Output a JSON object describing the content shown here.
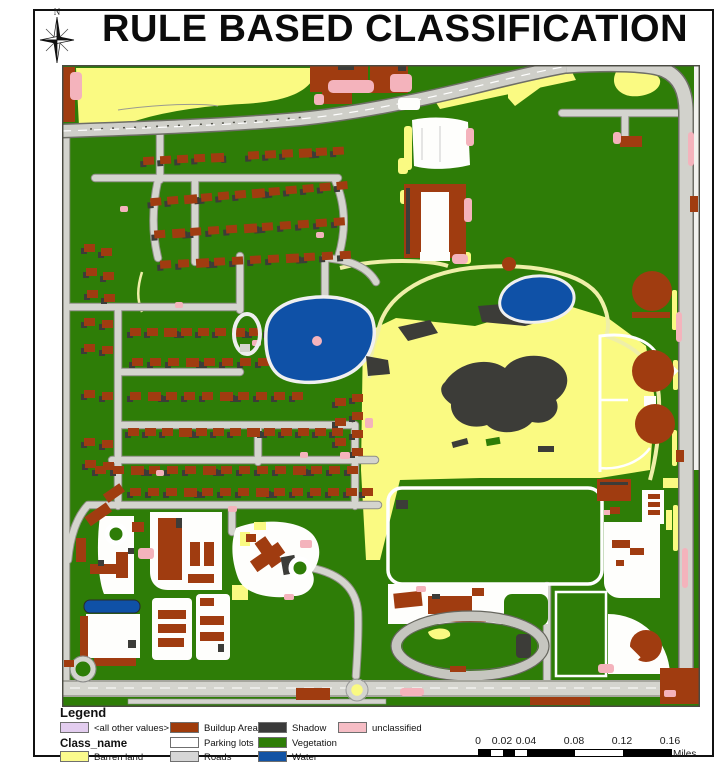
{
  "title": "RULE BASED CLASSIFICATION",
  "north_arrow": {
    "label": "N"
  },
  "legend": {
    "title": "Legend",
    "class_field_label": "Class_name",
    "items": [
      {
        "label": "<all other values>",
        "color": "#E3CDEF"
      },
      {
        "label": "Barren land",
        "color": "#FBFB8D"
      },
      {
        "label": "Buildup Area",
        "color": "#9E3B0B"
      },
      {
        "label": "Parking lots",
        "color": "#FFFFFF"
      },
      {
        "label": "Roads",
        "color": "#D6D6D6"
      },
      {
        "label": "Shadow",
        "color": "#3A3A3A"
      },
      {
        "label": "Vegetation",
        "color": "#2E7D07"
      },
      {
        "label": "Water",
        "color": "#1253A4"
      },
      {
        "label": "unclassified",
        "color": "#F6BDC5"
      }
    ]
  },
  "scale_bar": {
    "ticks": [
      "0",
      "0.02",
      "0.04",
      "0.08",
      "0.12",
      "0.16"
    ],
    "unit": "Miles"
  },
  "map": {
    "colors": {
      "vegetation": "#2E7D07",
      "barren": "#FAFA82",
      "buildup": "#A03C10",
      "roads": "#D4D4CE",
      "road_edge": "#8F8F86",
      "parking": "#FEFEFC",
      "water": "#0F51A7",
      "shadow": "#3C3C38",
      "unclassified": "#F4B3BC",
      "pale_road": "#EFEFA8"
    }
  }
}
